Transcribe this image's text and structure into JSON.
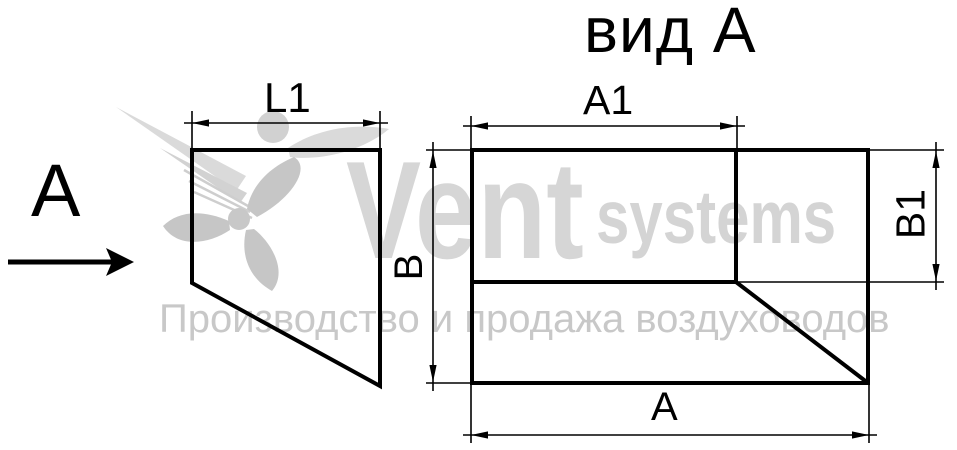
{
  "title": "вид А",
  "left_view": {
    "view_label": "А",
    "dim_width": "L1"
  },
  "plan_view": {
    "dim_top": "A1",
    "dim_bottom": "А",
    "dim_left": "В",
    "dim_right": "B1"
  },
  "watermark": {
    "brand": "Vent",
    "brand_suffix": "systems",
    "tagline": "Производство и продажа воздуховодов"
  },
  "colors": {
    "line": "#000000",
    "watermark_brand": "#d5d5d5",
    "watermark_tagline": "#c8c8c8",
    "watermark_logo": "#c6c6c6"
  }
}
